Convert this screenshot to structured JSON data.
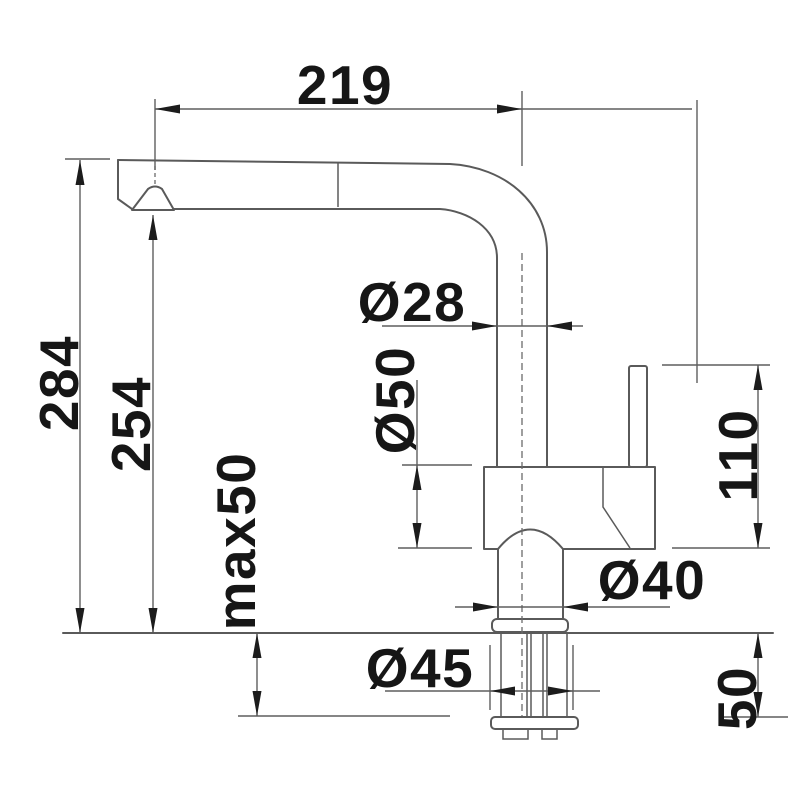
{
  "drawing": {
    "kind": "faucet-dimension-drawing",
    "colors": {
      "background": "#ffffff",
      "line": "#5a5a5a",
      "ink": "#161616"
    },
    "dimensions": {
      "spout_reach": {
        "label": "219"
      },
      "overall_height": {
        "label": "284"
      },
      "spout_height": {
        "label": "254"
      },
      "deck_max_thickness": {
        "label": "max50"
      },
      "spout_pipe_dia": {
        "label": "Ø28"
      },
      "body_dia": {
        "label": "Ø50"
      },
      "handle_height": {
        "label": "110"
      },
      "base_dia": {
        "label": "Ø40"
      },
      "flange_dia": {
        "label": "Ø45"
      },
      "under_deck_depth": {
        "label": "50"
      }
    }
  }
}
